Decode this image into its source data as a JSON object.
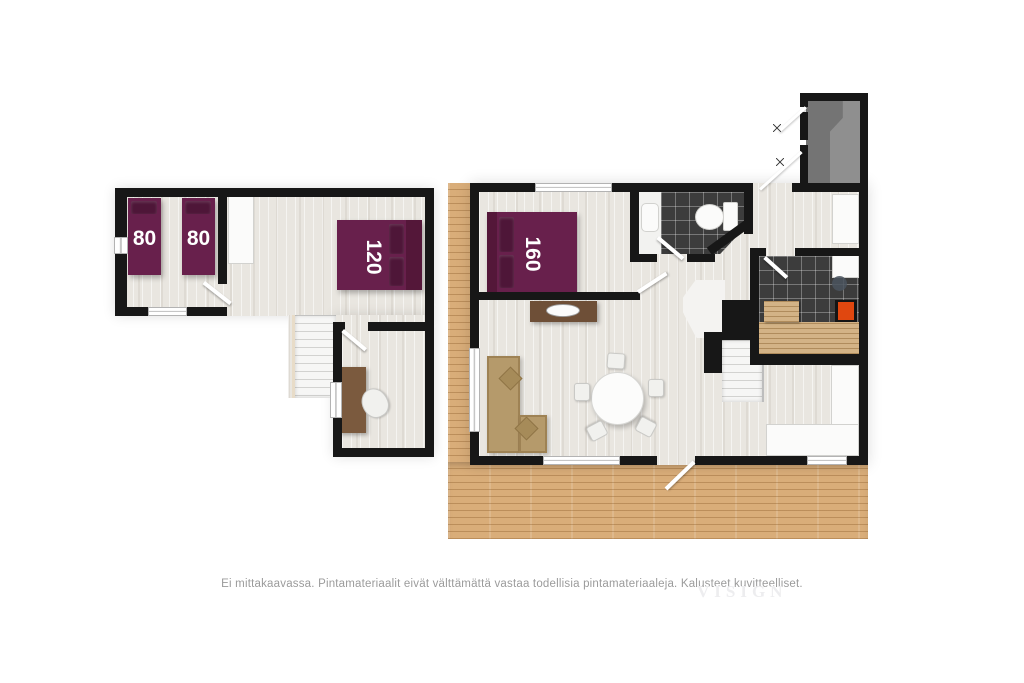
{
  "plans": {
    "upper": {
      "name": "upper-floor",
      "bed1_label": "80",
      "bed2_label": "80",
      "bed3_label": "120"
    },
    "main": {
      "name": "main-floor",
      "bed_label": "160"
    }
  },
  "footer": {
    "disclaimer": "Ei mittakaavassa. Pintamateriaalit eivät välttämättä vastaa todellisia pintamateriaaleja. Kalusteet kuvitteelliset.",
    "watermark": "VISIGN"
  },
  "colors": {
    "wall": "#171717",
    "floor": "#e9e6e0",
    "deck_wood": "#d9ad79",
    "bed_purple": "#68204c",
    "tile_dark": "#3c3c3c",
    "bench_wood": "#d3b386",
    "sauna_heater": "#e0470f",
    "sofa_tan": "#b59a6b",
    "storage_gray": "#747474"
  }
}
